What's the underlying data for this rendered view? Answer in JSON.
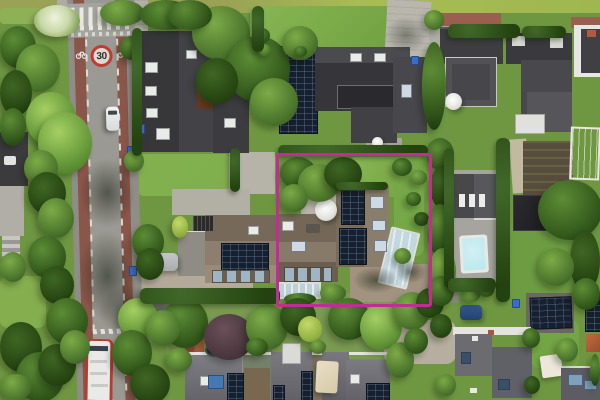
{
  "scene": {
    "description": "Top-down aerial drone photograph of a green suburban residential neighborhood; a magenta rectangle outlines the subject property containing an L-shaped brown-roofed house with solar panels, a glass conservatory, a round white parasol and a gravel drive.",
    "road": {
      "speed_limit_marking": "30"
    },
    "highlight": {
      "shape": "rectangle",
      "purpose": "subject-property-boundary",
      "color": "#c52a95"
    },
    "landmarks": [
      "zebra crosswalk on raised plateau",
      "30 zone road marking with bicycle symbols",
      "red cycle lanes on both road edges",
      "white car on road",
      "red and white bus at bottom junction",
      "swimming pool",
      "greenhouse",
      "rooftop solar panels",
      "terraced houses row at bottom",
      "silver parked car",
      "blue parked car",
      "white garden parasols"
    ]
  },
  "colors": {
    "highlight": "#c52a95",
    "asphalt": "#9b9993",
    "bike-lane": "#8a564a",
    "crosswalk-stripe": "#e9e9e4",
    "lawn": "#7fae4c",
    "tree-dark": "#2f5419",
    "roof-dark": "#3a3a3d",
    "roof-brown": "#8d7f6e",
    "solar-panel": "#16202e",
    "pool-water": "#b8e8ec",
    "gravel": "#b3aa9a",
    "bus-red": "#b73c30",
    "speed-sign-red": "#c23b30"
  }
}
